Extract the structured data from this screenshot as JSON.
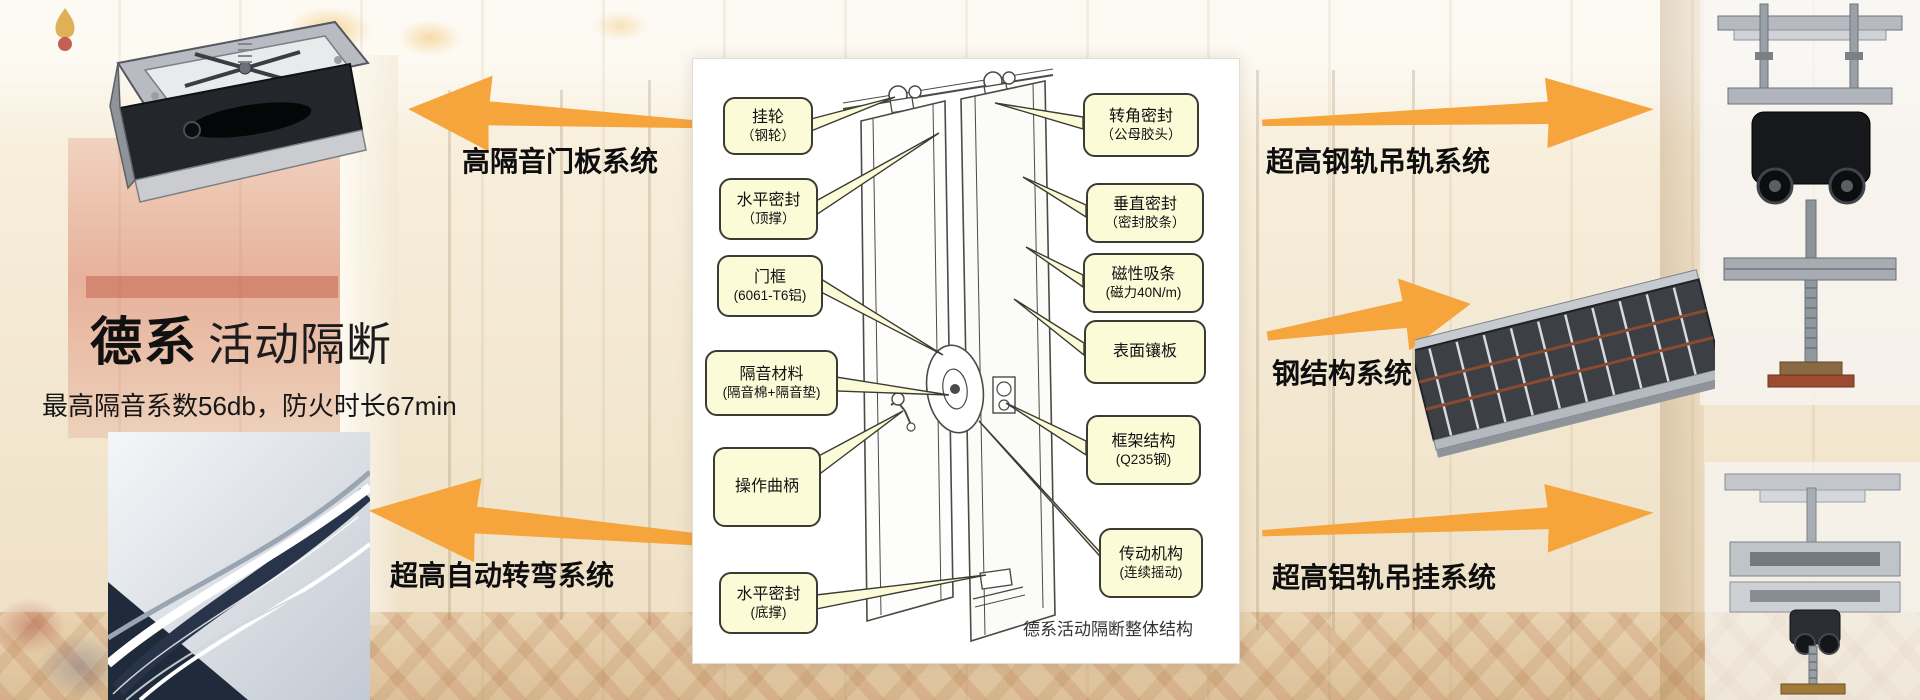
{
  "slide": {
    "title_primary": "德系",
    "title_secondary": "活动隔断",
    "subtitle": "最高隔音系数56db，防火时长67min"
  },
  "arrow_labels": {
    "door_panel": "高隔音门板系统",
    "steel_rail": "超高钢轨吊轨系统",
    "steel_structure": "钢结构系统",
    "aluminum_rail": "超高铝轨吊挂系统",
    "auto_turning": "超高自动转弯系统"
  },
  "diagram": {
    "caption": "德系活动隔断整体结构",
    "callouts_left": [
      {
        "line1": "挂轮",
        "line2": "（钢轮）"
      },
      {
        "line1": "水平密封",
        "line2": "（顶撑）"
      },
      {
        "line1": "门框",
        "line2": "(6061-T6铝)"
      },
      {
        "line1": "隔音材料",
        "line2": "(隔音棉+隔音垫)"
      },
      {
        "line1": "操作曲柄",
        "line2": ""
      },
      {
        "line1": "水平密封",
        "line2": "(底撑)"
      }
    ],
    "callouts_right": [
      {
        "line1": "转角密封",
        "line2": "（公母胶头）"
      },
      {
        "line1": "垂直密封",
        "line2": "（密封胶条）"
      },
      {
        "line1": "磁性吸条",
        "line2": "(磁力40N/m)"
      },
      {
        "line1": "表面镶板",
        "line2": ""
      },
      {
        "line1": "框架结构",
        "line2": "(Q235钢)"
      },
      {
        "line1": "传动机构",
        "line2": "(连续摇动)"
      }
    ]
  },
  "colors": {
    "arrow_orange": "#F6A53C",
    "callout_fill": "#FCFBD8",
    "callout_border": "#3B3B33",
    "text_black": "#111111"
  }
}
